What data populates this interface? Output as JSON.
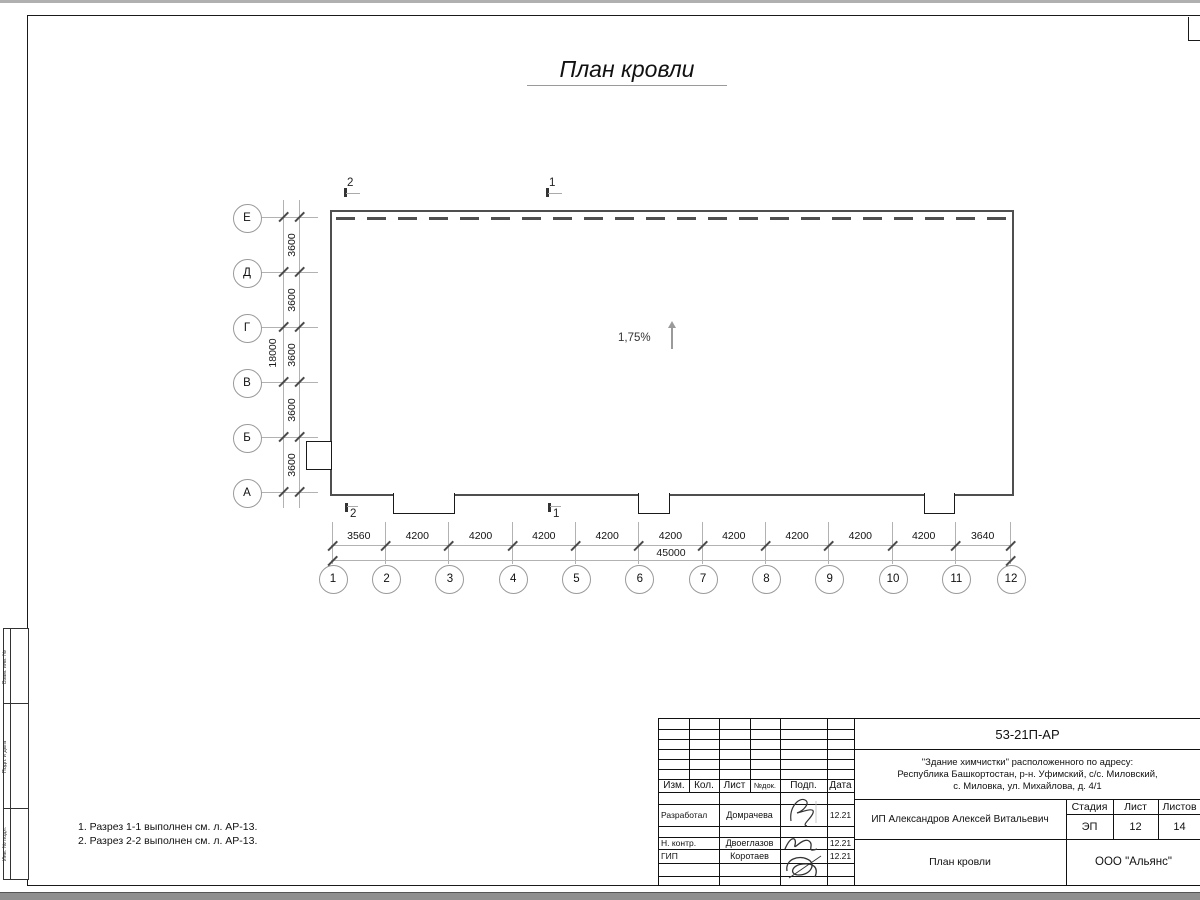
{
  "title": "План кровли",
  "plan": {
    "slope_label": "1,75%",
    "section_marks": {
      "top_left": "2",
      "top_right": "1",
      "bottom_left": "2",
      "bottom_right": "1"
    },
    "row_axes": [
      "Е",
      "Д",
      "Г",
      "В",
      "Б",
      "А"
    ],
    "row_spacing_labels": [
      "3600",
      "3600",
      "3600",
      "3600",
      "3600"
    ],
    "row_total_label": "18000",
    "col_axes": [
      "1",
      "2",
      "3",
      "4",
      "5",
      "6",
      "7",
      "8",
      "9",
      "10",
      "11",
      "12"
    ],
    "col_spacing_labels": [
      "3560",
      "4200",
      "4200",
      "4200",
      "4200",
      "4200",
      "4200",
      "4200",
      "4200",
      "4200",
      "3640"
    ],
    "col_total_label": "45000"
  },
  "notes": {
    "line1": "1. Разрез 1-1 выполнен см. л. АР-13.",
    "line2": "2. Разрез 2-2 выполнен см. л. АР-13."
  },
  "side_stamp": {
    "box1": "Взам. инв. №",
    "box2": "Подп. и дата",
    "box3": "Инв. № подл."
  },
  "title_block": {
    "doc_number": "53-21П-АР",
    "project_line1": "\"Здание химчистки\" расположенного по адресу:",
    "project_line2": "Республика Башкортостан, р-н. Уфимский, с/с. Миловский,",
    "project_line3": "с. Миловка, ул. Михайлова, д. 4/1",
    "header_cols": {
      "izm": "Изм.",
      "kol": "Кол.",
      "list": "Лист",
      "ndok": "№док.",
      "podp": "Подп.",
      "data": "Дата"
    },
    "rows": [
      {
        "role": "Разработал",
        "name": "Домрачева",
        "date": "12.21"
      },
      {
        "role": "Н. контр.",
        "name": "Двоеглазов",
        "date": "12.21"
      },
      {
        "role": "ГИП",
        "name": "Коротаев",
        "date": "12.21"
      }
    ],
    "client": "ИП Александров Алексей Витальевич",
    "stage_label": "Стадия",
    "stage_value": "ЭП",
    "sheet_label": "Лист",
    "sheet_value": "12",
    "sheets_label": "Листов",
    "sheets_value": "14",
    "drawing_name": "План кровли",
    "company": "ООО \"Альянс\""
  }
}
